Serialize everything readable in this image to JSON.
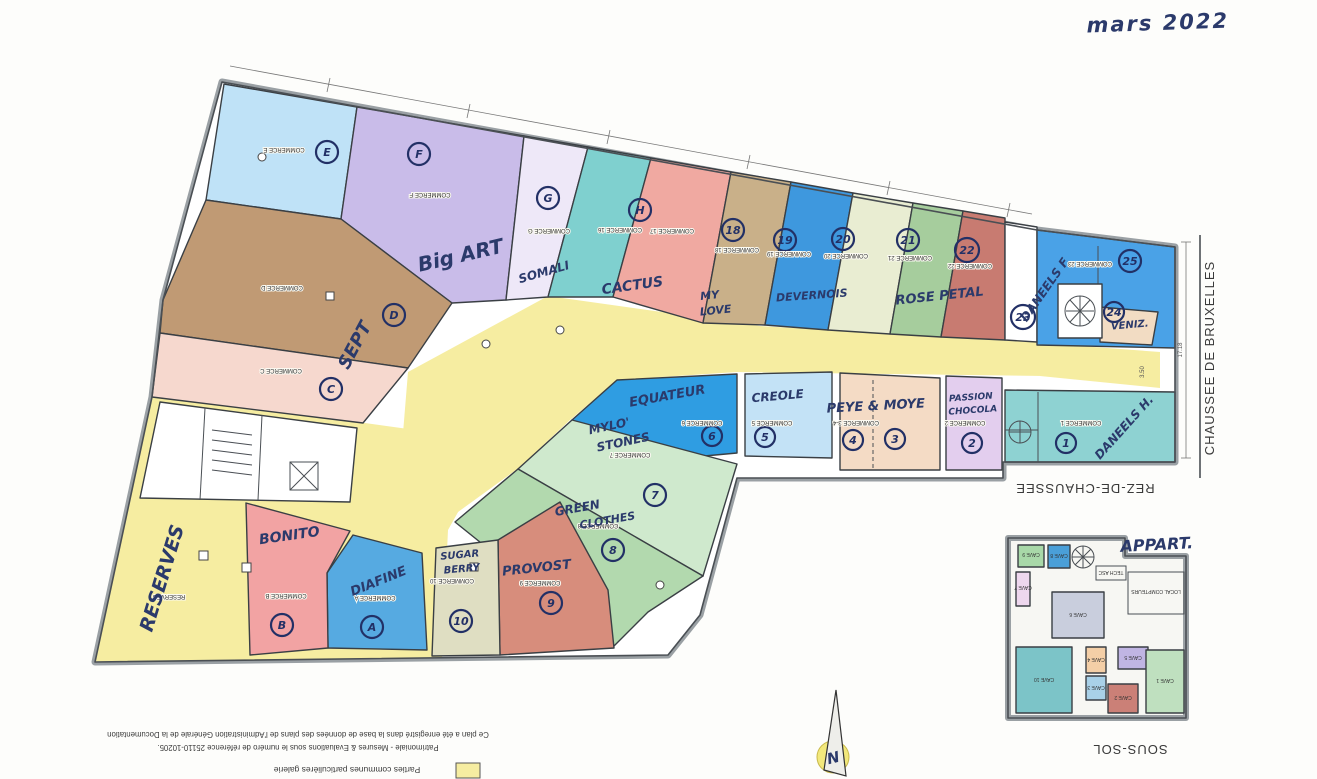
{
  "note_top_right": "mars 2022",
  "street_label": "CHAUSSEE DE BRUXELLES",
  "floor_ground_label": "REZ-DE-CHAUSSEE",
  "floor_basement_label": "SOUS-SOL",
  "apartment_note": "APPART.",
  "compass_label": "N",
  "dimension_right": "17.18",
  "dimension_inner": "3.50",
  "gallery_color": "#f6eda1",
  "footer": {
    "registration_line1": "Ce plan a été enregistré dans la base de données des plans de l'Administration Générale de la Documentation",
    "registration_line2": "Patrimoniale - Mesures & Evaluations sous le numéro de référence 25110-10205.",
    "legend_label": "Parties communes particulières galerie",
    "legend_color": "#f6eda1"
  },
  "zones": {
    "E": {
      "commerce_label": "COMMERCE E",
      "circle": "E",
      "color": "#bfe2f7"
    },
    "F": {
      "commerce_label": "COMMERCE F",
      "circle": "F",
      "shop_name": "Big ART",
      "color": "#c9bce9"
    },
    "D": {
      "commerce_label": "COMMERCE D",
      "circle": "D",
      "color": "#c09a74"
    },
    "C": {
      "commerce_label": "COMMERCE C",
      "circle": "C",
      "shop_name": "SEPT",
      "color": "#f6d8ce"
    },
    "G": {
      "commerce_label": "COMMERCE G",
      "circle": "G",
      "shop_name": "SOMALI",
      "color": "#eee8f8"
    },
    "16": {
      "commerce_label": "COMMERCE 16",
      "circle": "H",
      "shop_name": "CACTUS",
      "color": "#7fd0cf"
    },
    "17": {
      "commerce_label": "COMMERCE 17",
      "color": "#f0a9a1"
    },
    "18": {
      "commerce_label": "COMMERCE 18",
      "circle": "18",
      "shop_name_line1": "MY",
      "shop_name_line2": "LOVE",
      "color": "#c9b089"
    },
    "19": {
      "commerce_label": "COMMERCE 19",
      "circle": "19",
      "shop_name": "DEVERNOIS",
      "color": "#3e98de"
    },
    "20": {
      "commerce_label": "COMMERCE 20",
      "circle": "20",
      "color": "#e9edd2"
    },
    "21": {
      "commerce_label": "COMMERCE 21",
      "circle": "21",
      "shop_name": "ROSE PETAL",
      "color": "#a6cd9d"
    },
    "22": {
      "commerce_label": "COMMERCE 22",
      "circle": "22",
      "color": "#c87b71"
    },
    "23": {
      "commerce_label": "COMMERCE 23",
      "circle": "23",
      "shop_name": "DANEELS F",
      "color": "#4aa2e7"
    },
    "24": {
      "circle": "24",
      "shop_name": "VENIZ.",
      "color": "#f2dcc3"
    },
    "25": {
      "circle": "25"
    },
    "1": {
      "commerce_label": "COMMERCE 1",
      "circle": "1",
      "shop_name": "DANEELS H.",
      "color": "#8ed2d2"
    },
    "2": {
      "commerce_label": "COMMERCE 2",
      "circle": "2",
      "shop_name_line1": "PASSION",
      "shop_name_line2": "CHOCOLA",
      "color": "#e3ceee"
    },
    "34": {
      "commerce_label": "COMMERCE 3-4",
      "circle_left": "4",
      "circle_right": "3",
      "shop_name": "PEYE & MOYE",
      "color": "#f4dbc5"
    },
    "5": {
      "commerce_label": "COMMERCE 5",
      "circle": "5",
      "shop_name": "CREOLE",
      "color": "#c3e2f6"
    },
    "6": {
      "commerce_label": "COMMERCE 6",
      "circle": "6",
      "shop_name": "EQUATEUR",
      "color": "#2f9de2"
    },
    "7": {
      "commerce_label": "COMMERCE 7",
      "circle": "7",
      "shop_name_line1": "MYLO'",
      "shop_name_line2": "STONES",
      "color": "#cfe9cd"
    },
    "8": {
      "commerce_label": "COMMERCE 8",
      "circle": "8",
      "shop_name_line1": "GREEN",
      "shop_name_line2": "CLOTHES",
      "color": "#b2d9ae"
    },
    "9": {
      "commerce_label": "COMMERCE 9",
      "circle": "9",
      "shop_name": "PROVOST",
      "color": "#d78d7c"
    },
    "10": {
      "commerce_label": "COMMERCE 10",
      "circle": "10",
      "shop_name_line1": "SUGAR",
      "shop_name_line2": "BERRY",
      "color": "#dfdec2"
    },
    "A": {
      "commerce_label": "COMMERCE A",
      "circle": "A",
      "shop_name": "DIAFINE",
      "color": "#56aae1"
    },
    "B": {
      "commerce_label": "COMMERCE B",
      "circle": "B",
      "shop_name": "BONITO",
      "color": "#f2a3a3"
    },
    "R": {
      "commerce_label": "RESERVES",
      "shop_name": "RESERVES",
      "color": "#f6eda1"
    }
  },
  "basement": {
    "rooms": {
      "cave1": {
        "label": "CAVE 1",
        "color": "#bfe0bf"
      },
      "cave2": {
        "label": "CAVE 2",
        "color": "#cb8077"
      },
      "cave3": {
        "label": "CAVE 3",
        "color": "#a9d1e8"
      },
      "cave4": {
        "label": "CAVE 4",
        "color": "#f4cfa7"
      },
      "cave5": {
        "label": "CAVE 5",
        "color": "#c0b5e3"
      },
      "cave6": {
        "label": "CAVE 6",
        "color": "#c9cedd"
      },
      "cave7": {
        "label": "CAVE 7",
        "color": "#eed7ee"
      },
      "cave8": {
        "label": "CAVE 8",
        "color": "#4a9fd8"
      },
      "cave9": {
        "label": "CAVE 9",
        "color": "#a8d8a8"
      },
      "cave10": {
        "label": "CAVE 10",
        "color": "#7cc4c8"
      },
      "tech": {
        "label": "TECH ASC"
      },
      "compteurs": {
        "label": "LOCAL COMPTEURS"
      }
    }
  }
}
